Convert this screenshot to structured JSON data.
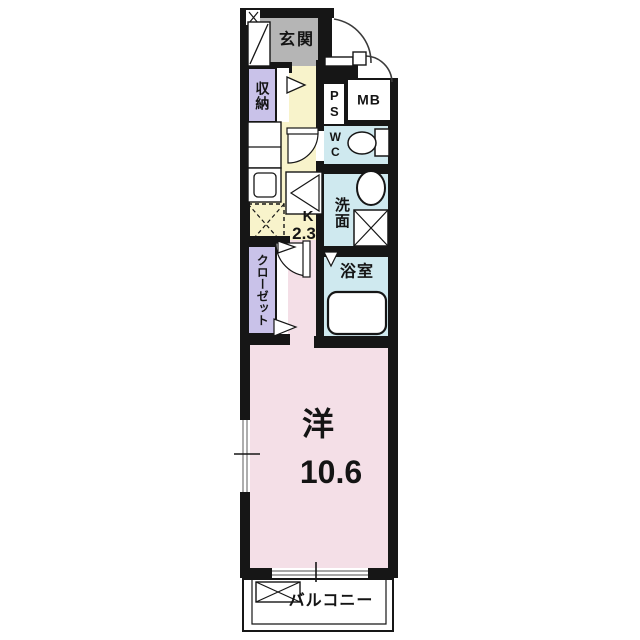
{
  "plan": {
    "type": "apartment-floor-plan",
    "rooms": {
      "genkan": {
        "label": "玄関",
        "color": "#b5b5b5"
      },
      "storage": {
        "label": "収納",
        "color": "#c9c2e9"
      },
      "pipe_space": {
        "label": "PS",
        "color": "#ffffff"
      },
      "meter_box": {
        "label": "MB",
        "color": "#ffffff"
      },
      "wc": {
        "label": "WC",
        "color": "#cfe9ef"
      },
      "washroom": {
        "label": "洗面",
        "color": "#cfe9ef"
      },
      "kitchen": {
        "label": "K",
        "size": "2.3",
        "color": "#f8f3cb"
      },
      "bathroom": {
        "label": "浴室",
        "color": "#cfe9ef"
      },
      "closet": {
        "label": "クローゼット",
        "color": "#c9c2e9"
      },
      "western_room": {
        "label": "洋",
        "size": "10.6",
        "color": "#f4dfe7"
      },
      "balcony": {
        "label": "バルコニー",
        "color": "#ffffff"
      }
    },
    "fixtures": [
      "entrance-door-swing",
      "shoe-cabinet",
      "storage-door-triangle",
      "kitchen-counter",
      "kitchen-sink",
      "refrigerator-space",
      "washing-machine-space-dashed",
      "interior-door-swing",
      "toilet",
      "toilet-tank",
      "washbasin",
      "washing-machine-space",
      "bathroom-folding-door",
      "bathtub",
      "closet-door-triangles",
      "window-left",
      "window-balcony",
      "balcony-equipment-space"
    ],
    "colors": {
      "wall": "#161616",
      "line": "#1a1a1a",
      "door_arc": "#3a3a3a",
      "glass": "#8a8a8a",
      "background": "#ffffff"
    }
  }
}
